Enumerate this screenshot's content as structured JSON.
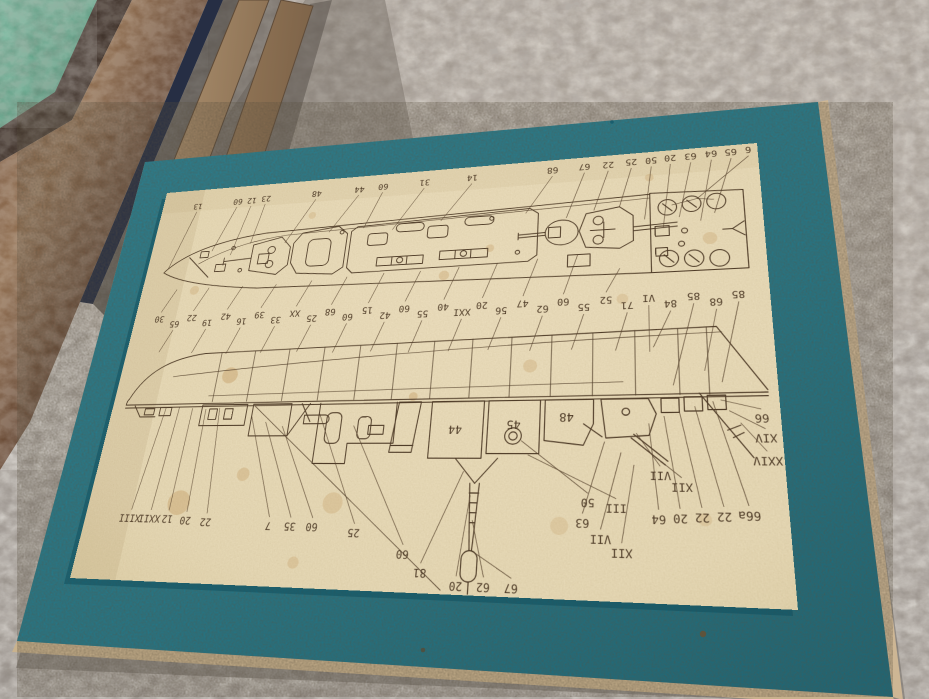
{
  "scene": {
    "description": "Photo of an upside-down vintage warship model assembly plan sheet on a teal backing board, on gray carpet, picture frames stacked top-left",
    "objects": [
      "carpet",
      "stacked-picture-frames",
      "framed-picture-green",
      "teal-backing-board",
      "plan-sheet"
    ],
    "colors": {
      "carpet": "#a7a098",
      "carpet_bright": "#b8b1a8",
      "board_teal": "#22839a",
      "board_teal_dark": "#176d80",
      "board_edge_tan": "#c9b28d",
      "paper": "#eddfbe",
      "paper_edge": "#e0d0a8",
      "ink": "#4f3c28",
      "foxing": "#c2995f",
      "frame_dark_brown": "#32241c",
      "frame_marble_brown": "#7a5840",
      "frame_navy": "#262e44",
      "frame_tan": "#b99c7a",
      "picture_green": "#55a184"
    }
  },
  "sheet": {
    "views": [
      "deck-plan-top-view",
      "hull-side-profile-view"
    ],
    "orientation": "printed labels appear rotated 180 degrees (sheet photographed upside down)",
    "inline_part_numbers": [
      {
        "t": "44",
        "x": 340,
        "y": 266
      },
      {
        "t": "45",
        "x": 390,
        "y": 262
      },
      {
        "t": "48",
        "x": 434,
        "y": 256
      }
    ],
    "deck_plan_labels_top": [
      {
        "t": "13",
        "x": 42,
        "y": 20,
        "tx": 24,
        "ty": 94
      },
      {
        "t": "60",
        "x": 88,
        "y": 18,
        "tx": 70,
        "ty": 76
      },
      {
        "t": "12",
        "x": 104,
        "y": 18,
        "tx": 92,
        "ty": 82
      },
      {
        "t": "23",
        "x": 120,
        "y": 17,
        "tx": 112,
        "ty": 70
      },
      {
        "t": "48",
        "x": 176,
        "y": 16,
        "tx": 150,
        "ty": 72
      },
      {
        "t": "44",
        "x": 222,
        "y": 15,
        "tx": 196,
        "ty": 63
      },
      {
        "t": "60",
        "x": 247,
        "y": 14,
        "tx": 232,
        "ty": 61
      },
      {
        "t": "31",
        "x": 290,
        "y": 13,
        "tx": 262,
        "ty": 65
      },
      {
        "t": "14",
        "x": 338,
        "y": 12,
        "tx": 310,
        "ty": 59
      },
      {
        "t": "68",
        "x": 416,
        "y": 11,
        "tx": 392,
        "ty": 57
      },
      {
        "t": "67",
        "x": 446,
        "y": 10,
        "tx": 430,
        "ty": 65
      },
      {
        "t": "22",
        "x": 468,
        "y": 10,
        "tx": 455,
        "ty": 59
      },
      {
        "t": "25",
        "x": 489,
        "y": 9,
        "tx": 478,
        "ty": 57
      },
      {
        "t": "50",
        "x": 507,
        "y": 9,
        "tx": 500,
        "ty": 72
      },
      {
        "t": "20",
        "x": 524,
        "y": 8,
        "tx": 516,
        "ty": 82
      },
      {
        "t": "63",
        "x": 542,
        "y": 8,
        "tx": 530,
        "ty": 72
      },
      {
        "t": "64",
        "x": 560,
        "y": 7,
        "tx": 548,
        "ty": 77
      },
      {
        "t": "65",
        "x": 577,
        "y": 7,
        "tx": 560,
        "ty": 70
      },
      {
        "t": "6",
        "x": 592,
        "y": 6,
        "tx": 546,
        "ty": 54
      }
    ],
    "mid_labels": [
      {
        "t": "30",
        "x": 28,
        "y": 150,
        "tx": 40,
        "ty": 118
      },
      {
        "t": "65",
        "x": 46,
        "y": 156,
        "tx": 36,
        "ty": 186
      },
      {
        "t": "22",
        "x": 64,
        "y": 150,
        "tx": 76,
        "ty": 118
      },
      {
        "t": "19",
        "x": 82,
        "y": 156,
        "tx": 72,
        "ty": 188
      },
      {
        "t": "42",
        "x": 101,
        "y": 150,
        "tx": 113,
        "ty": 118
      },
      {
        "t": "16",
        "x": 119,
        "y": 156,
        "tx": 109,
        "ty": 190
      },
      {
        "t": "39",
        "x": 137,
        "y": 150,
        "tx": 149,
        "ty": 118
      },
      {
        "t": "33",
        "x": 155,
        "y": 156,
        "tx": 145,
        "ty": 190
      },
      {
        "t": "XX",
        "x": 174,
        "y": 150,
        "tx": 186,
        "ty": 116
      },
      {
        "t": "25",
        "x": 192,
        "y": 156,
        "tx": 182,
        "ty": 190
      },
      {
        "t": "68",
        "x": 210,
        "y": 150,
        "tx": 222,
        "ty": 114
      },
      {
        "t": "60",
        "x": 228,
        "y": 156,
        "tx": 218,
        "ty": 192
      },
      {
        "t": "15",
        "x": 247,
        "y": 150,
        "tx": 259,
        "ty": 112
      },
      {
        "t": "42",
        "x": 265,
        "y": 156,
        "tx": 255,
        "ty": 192
      },
      {
        "t": "60",
        "x": 283,
        "y": 150,
        "tx": 295,
        "ty": 112
      },
      {
        "t": "55",
        "x": 301,
        "y": 156,
        "tx": 291,
        "ty": 194
      },
      {
        "t": "40",
        "x": 320,
        "y": 150,
        "tx": 332,
        "ty": 110
      },
      {
        "t": "XXI",
        "x": 338,
        "y": 156,
        "tx": 328,
        "ty": 194
      },
      {
        "t": "20",
        "x": 356,
        "y": 150,
        "tx": 368,
        "ty": 108
      },
      {
        "t": "56",
        "x": 374,
        "y": 156,
        "tx": 364,
        "ty": 194
      },
      {
        "t": "47",
        "x": 393,
        "y": 150,
        "tx": 405,
        "ty": 106
      },
      {
        "t": "62",
        "x": 411,
        "y": 156,
        "tx": 401,
        "ty": 196
      },
      {
        "t": "60",
        "x": 429,
        "y": 150,
        "tx": 441,
        "ty": 104
      },
      {
        "t": "55",
        "x": 447,
        "y": 156,
        "tx": 437,
        "ty": 196
      },
      {
        "t": "52",
        "x": 466,
        "y": 150,
        "tx": 478,
        "ty": 120
      },
      {
        "t": "71",
        "x": 484,
        "y": 156,
        "tx": 474,
        "ty": 198
      },
      {
        "t": "VI",
        "x": 502,
        "y": 150,
        "tx": 502,
        "ty": 200
      },
      {
        "t": "84",
        "x": 520,
        "y": 156,
        "tx": 505,
        "ty": 196
      },
      {
        "t": "85",
        "x": 539,
        "y": 150,
        "tx": 520,
        "ty": 230
      },
      {
        "t": "68",
        "x": 557,
        "y": 156,
        "tx": 545,
        "ty": 218
      },
      {
        "t": "85",
        "x": 575,
        "y": 150,
        "tx": 558,
        "ty": 228
      }
    ],
    "bottom_labels": [
      {
        "t": "XIII",
        "x": 46,
        "y": 346,
        "tx": 58,
        "ty": 243
      },
      {
        "t": "XXII",
        "x": 66,
        "y": 346,
        "tx": 72,
        "ty": 243
      },
      {
        "t": "12",
        "x": 84,
        "y": 346,
        "tx": 86,
        "ty": 244
      },
      {
        "t": "20",
        "x": 102,
        "y": 347,
        "tx": 100,
        "ty": 245
      },
      {
        "t": "22",
        "x": 122,
        "y": 348,
        "tx": 114,
        "ty": 244
      },
      {
        "t": "7",
        "x": 182,
        "y": 350,
        "tx": 148,
        "ty": 252
      },
      {
        "t": "35",
        "x": 202,
        "y": 350,
        "tx": 163,
        "ty": 258
      },
      {
        "t": "60",
        "x": 222,
        "y": 350,
        "tx": 180,
        "ty": 262
      },
      {
        "t": "25",
        "x": 260,
        "y": 354,
        "tx": 214,
        "ty": 250
      },
      {
        "t": "60",
        "x": 304,
        "y": 370,
        "tx": 248,
        "ty": 262
      },
      {
        "t": "81",
        "x": 320,
        "y": 384,
        "tx": 350,
        "ty": 302
      },
      {
        "t": "20",
        "x": 350,
        "y": 393,
        "tx": 357,
        "ty": 322
      },
      {
        "t": "62",
        "x": 372,
        "y": 393,
        "tx": 360,
        "ty": 342
      },
      {
        "t": "67",
        "x": 394,
        "y": 393,
        "tx": 361,
        "ty": 366
      },
      {
        "t": "50",
        "x": 452,
        "y": 326,
        "tx": 397,
        "ty": 276
      },
      {
        "t": "III",
        "x": 474,
        "y": 330,
        "tx": 403,
        "ty": 288
      },
      {
        "t": "VII",
        "x": 508,
        "y": 304,
        "tx": 490,
        "ty": 270
      },
      {
        "t": "XII",
        "x": 524,
        "y": 313,
        "tx": 498,
        "ty": 284
      },
      {
        "t": "63",
        "x": 448,
        "y": 342,
        "tx": 465,
        "ty": 277
      },
      {
        "t": "VII",
        "x": 462,
        "y": 354,
        "tx": 478,
        "ty": 286
      },
      {
        "t": "XII",
        "x": 478,
        "y": 364,
        "tx": 488,
        "ty": 296
      },
      {
        "t": "64",
        "x": 506,
        "y": 338,
        "tx": 500,
        "ty": 262
      },
      {
        "t": "20",
        "x": 522,
        "y": 337,
        "tx": 512,
        "ty": 256
      },
      {
        "t": "22",
        "x": 538,
        "y": 336,
        "tx": 524,
        "ty": 252
      },
      {
        "t": "22",
        "x": 554,
        "y": 335,
        "tx": 536,
        "ty": 248
      },
      {
        "t": "66a",
        "x": 572,
        "y": 334,
        "tx": 550,
        "ty": 244
      }
    ],
    "edge_labels": [
      {
        "t": "66",
        "x": 586,
        "y": 258,
        "tx": 556,
        "ty": 243
      },
      {
        "t": "XIV",
        "x": 588,
        "y": 274,
        "tx": 562,
        "ty": 252
      },
      {
        "t": "XXIV",
        "x": 588,
        "y": 292,
        "tx": 570,
        "ty": 262
      }
    ],
    "foxing_spots": [
      {
        "x": 118,
        "y": 212,
        "r": 8,
        "o": 0.4
      },
      {
        "x": 92,
        "y": 332,
        "r": 11,
        "o": 0.38
      },
      {
        "x": 150,
        "y": 306,
        "r": 6,
        "o": 0.32
      },
      {
        "x": 238,
        "y": 330,
        "r": 9,
        "o": 0.28
      },
      {
        "x": 318,
        "y": 118,
        "r": 5,
        "o": 0.32
      },
      {
        "x": 402,
        "y": 210,
        "r": 6,
        "o": 0.28
      },
      {
        "x": 300,
        "y": 236,
        "r": 4,
        "o": 0.38
      },
      {
        "x": 210,
        "y": 380,
        "r": 5,
        "o": 0.28
      },
      {
        "x": 480,
        "y": 150,
        "r": 5,
        "o": 0.24
      },
      {
        "x": 555,
        "y": 95,
        "r": 6,
        "o": 0.28
      },
      {
        "x": 430,
        "y": 345,
        "r": 7,
        "o": 0.22
      },
      {
        "x": 540,
        "y": 338,
        "r": 5,
        "o": 0.22
      },
      {
        "x": 60,
        "y": 120,
        "r": 5,
        "o": 0.28
      },
      {
        "x": 505,
        "y": 28,
        "r": 4,
        "o": 0.28
      },
      {
        "x": 360,
        "y": 92,
        "r": 4,
        "o": 0.3
      },
      {
        "x": 175,
        "y": 42,
        "r": 4,
        "o": 0.25
      }
    ]
  }
}
